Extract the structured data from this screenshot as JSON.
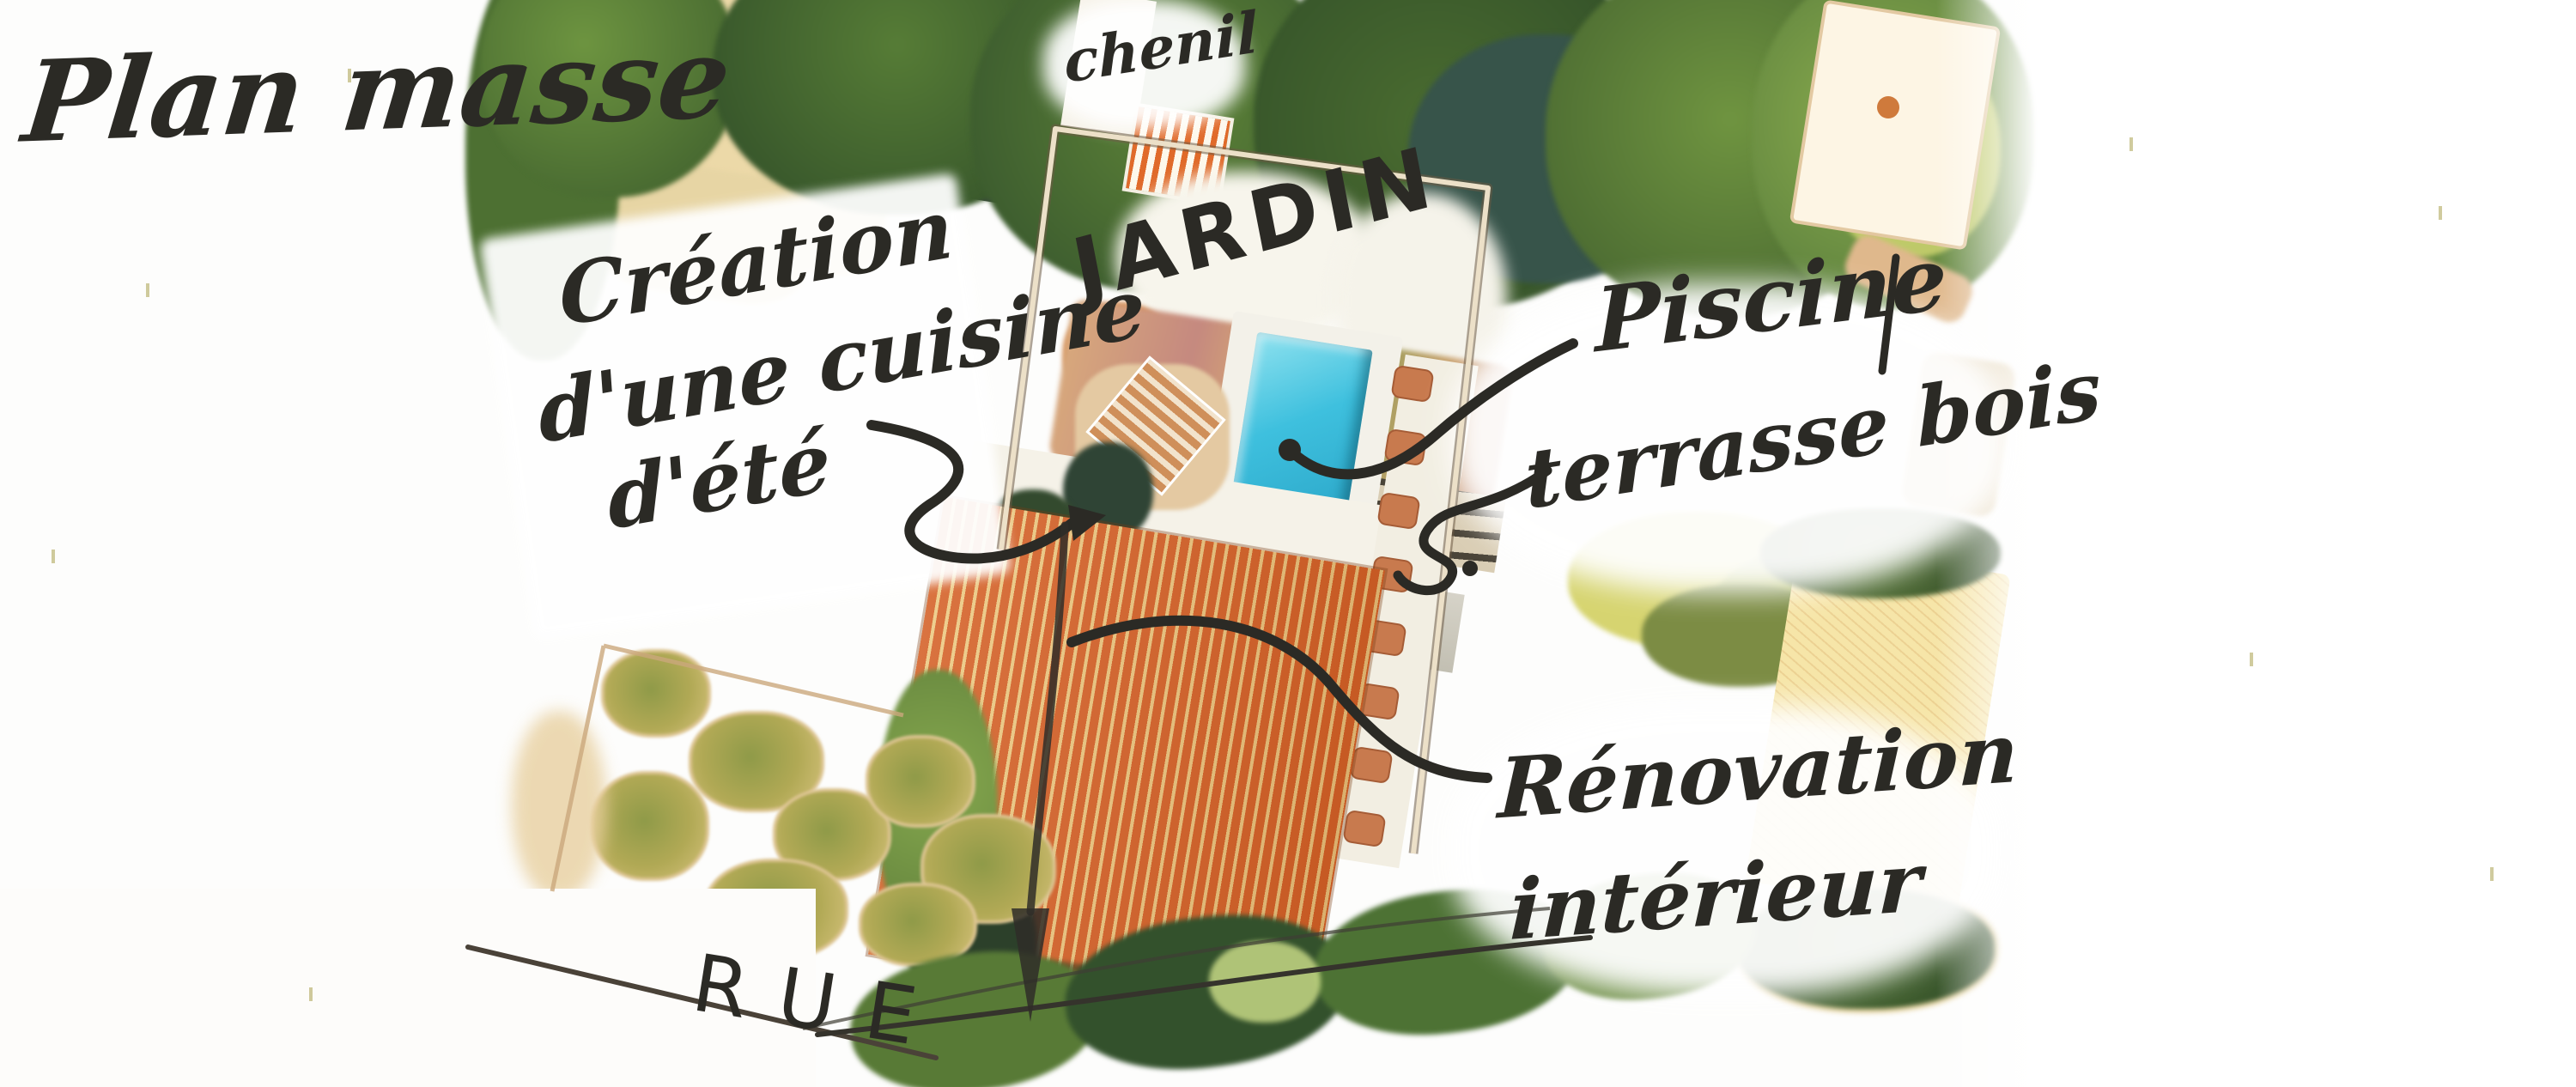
{
  "title": "Plan masse",
  "annotations": {
    "plan_masse": "Plan masse",
    "creation": {
      "line1": "Création",
      "line2": "d'une cuisine",
      "line3": "d'été"
    },
    "chenil": "chenil",
    "jardin": "JARDIN",
    "piscine": "Piscine",
    "terrasse_bois": "terrasse bois",
    "renovation": {
      "line1": "Rénovation",
      "line2": "intérieur"
    },
    "rue": "RUE"
  },
  "colors": {
    "ink": "#2b2a25",
    "roof_orange": "#d5632a",
    "roof_cream": "#edca83",
    "pool_blue": "#3ec0de",
    "pool_deep": "#2ba6c8",
    "pool_light": "#8fe2ef",
    "deck_white": "#f3f1e9",
    "paver": "#c87a4e",
    "foliage_dark": "#2f4c28",
    "foliage_mid": "#48682f",
    "foliage_light": "#8cae4e",
    "yellow_green": "#d6d470",
    "tan": "#ecd9a8",
    "field_tan": "#f6e5a8",
    "fence": "#ece0c8",
    "slate": "#4a5a52"
  }
}
